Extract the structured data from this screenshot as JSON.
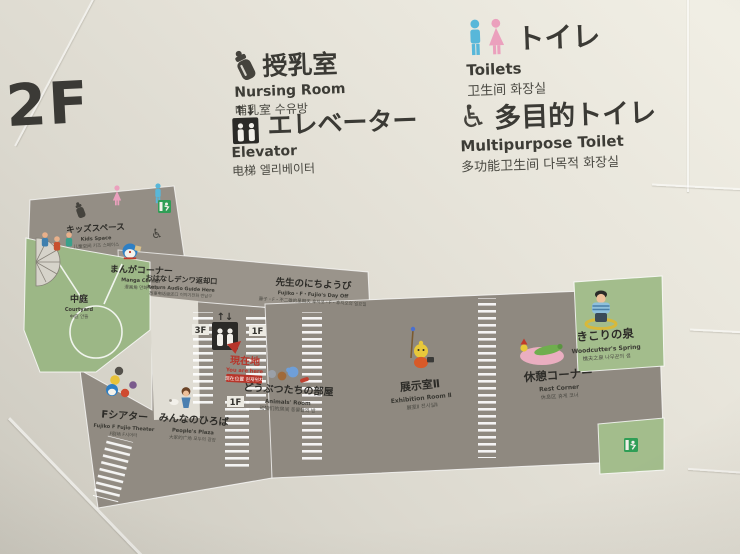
{
  "sign": {
    "floor": "2F",
    "legend": [
      {
        "ja": "授乳室",
        "en": "Nursing Room",
        "sub": "哺乳室  수유방",
        "icon": "baby-bottle-icon"
      },
      {
        "ja": "エレベーター",
        "en": "Elevator",
        "sub": "电梯  엘리베이터",
        "icon": "elevator-icon"
      },
      {
        "ja": "トイレ",
        "en": "Toilets",
        "sub": "卫生间  화장실",
        "icon": "toilet-figures-icon"
      },
      {
        "ja": "多目的トイレ",
        "en": "Multipurpose Toilet",
        "sub": "多功能卫生间  다목적 화장실",
        "icon": "wheelchair-icon"
      }
    ]
  },
  "icons": {
    "elevator_arrows": "↑↓",
    "wheelchair": "♿",
    "map_elevator_arrows": "↑↓"
  },
  "map": {
    "areas": [
      {
        "id": "kids-space",
        "ja": "キッズスペース",
        "en": "Kids Space",
        "sub": "儿童空间 키즈 스페이스"
      },
      {
        "id": "manga-corner",
        "ja": "まんがコーナー",
        "en": "Manga Corner",
        "sub": "漫画角 만화 코너"
      },
      {
        "id": "audio-guide-return",
        "ja": "おはなしデンワ返却口",
        "en": "Return Audio Guide Here",
        "sub": "故事电话返还口 이야기전화 반납구"
      },
      {
        "id": "fujiko-day-off",
        "ja": "先生のにちようび",
        "en": "Fujiko・F・Fujio's Day Off",
        "sub": "藤子・F・不二雄的星期天 후지코・F・후지오의 일요일"
      },
      {
        "id": "courtyard",
        "ja": "中庭",
        "en": "Courtyard",
        "sub": "中庭 안뜰"
      },
      {
        "id": "f-theater",
        "ja": "Fシアター",
        "en": "Fujiko F Fujio Theater",
        "sub": "F剧场 F시어터"
      },
      {
        "id": "peoples-plaza",
        "ja": "みんなのひろば",
        "en": "People's Plaza",
        "sub": "大家的广场 모두의 광장"
      },
      {
        "id": "animals-room",
        "ja": "どうぶつたちの部屋",
        "en": "Animals' Room",
        "sub": "动物们的房间 동물들의 방"
      },
      {
        "id": "exhibition-room-2",
        "ja": "展示室Ⅱ",
        "en": "Exhibition Room Ⅱ",
        "sub": "展室Ⅱ 전시실Ⅱ"
      },
      {
        "id": "rest-corner",
        "ja": "休憩コーナー",
        "en": "Rest Corner",
        "sub": "休息区 휴게 코너"
      },
      {
        "id": "woodcutters-spring",
        "ja": "きこりの泉",
        "en": "Woodcutter's Spring",
        "sub": "樵夫之泉 나무꾼의 샘"
      }
    ],
    "you_are_here": {
      "ja": "現在地",
      "en": "You are here",
      "sub": "现在位置 현재위치"
    },
    "stair_labels": [
      "3F",
      "1F",
      "1F"
    ]
  },
  "colors": {
    "wall": "#e4e1d7",
    "corridor": "#918b82",
    "room": "#e0ddd4",
    "green": "#9cb786",
    "accent_red": "#bb3326",
    "toilet_blue": "#58b7d9",
    "toilet_pink": "#eba0bd",
    "exit_green": "#2f9e56",
    "text": "#2f2e2a"
  }
}
